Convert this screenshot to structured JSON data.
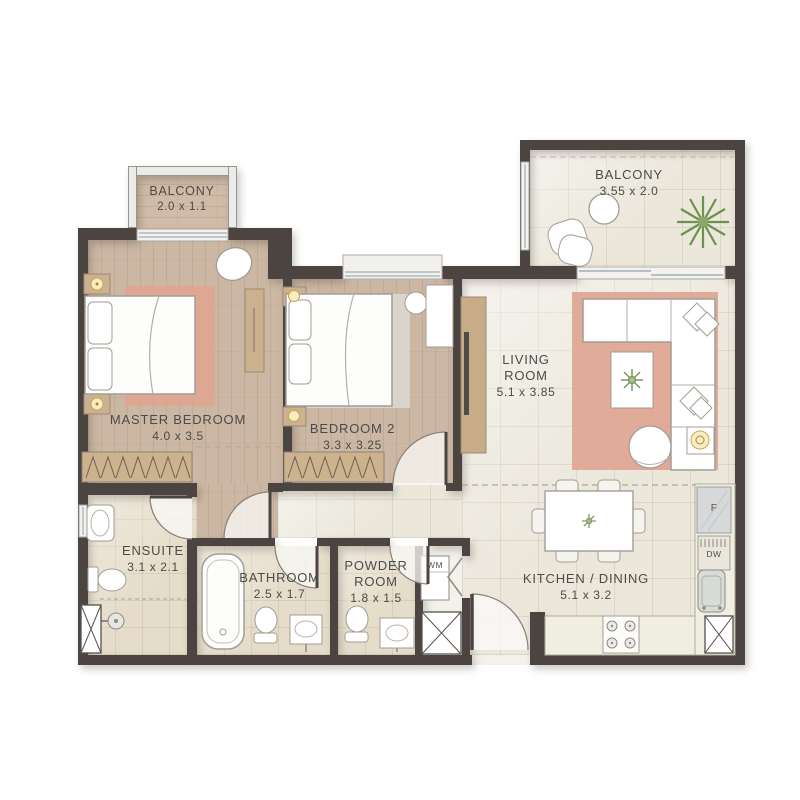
{
  "rooms": {
    "balcony_master": {
      "name": "BALCONY",
      "dims": "2.0 x 1.1"
    },
    "balcony_living": {
      "name": "BALCONY",
      "dims": "3.55 x 2.0"
    },
    "master_bedroom": {
      "name": "MASTER BEDROOM",
      "dims": "4.0 x 3.5"
    },
    "bedroom_2": {
      "name": "BEDROOM 2",
      "dims": "3.3 x 3.25"
    },
    "living_room": {
      "name": "LIVING ROOM",
      "dims": "5.1 x 3.85"
    },
    "ensuite": {
      "name": "ENSUITE",
      "dims": "3.1 x 2.1"
    },
    "bathroom": {
      "name": "BATHROOM",
      "dims": "2.5 x 1.7"
    },
    "powder_room": {
      "name": "POWDER ROOM",
      "dims": "1.8 x 1.5"
    },
    "kitchen_dining": {
      "name": "KITCHEN / DINING",
      "dims": "5.1 x 3.2"
    }
  },
  "appliances": {
    "fridge_label": "F",
    "dishwasher_label": "DW",
    "washer_label": "WM"
  },
  "colors": {
    "wall": "#4b4440",
    "wood_floor": "#cbb7a3",
    "tile_floor": "#ebe7db",
    "bath_tile": "#e5dcc9",
    "rug_salmon": "#e0a593",
    "rug_gray": "#d9d5cf",
    "plant_green": "#7d9a62",
    "lamp_gold": "#c9a84c"
  }
}
